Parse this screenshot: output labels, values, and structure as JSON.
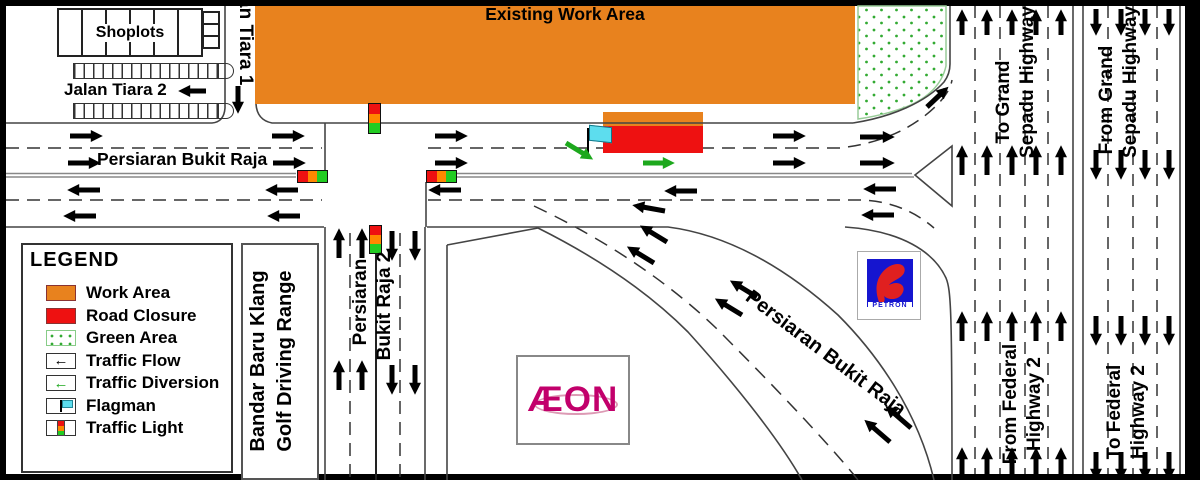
{
  "diagram_title": "Existing Work Area",
  "legend": {
    "title": "LEGEND",
    "items": [
      {
        "label": "Work Area",
        "swatch": "work-area"
      },
      {
        "label": "Road Closure",
        "swatch": "road-closure"
      },
      {
        "label": "Green Area",
        "swatch": "green-area"
      },
      {
        "label": "Traffic Flow",
        "swatch": "traffic-flow"
      },
      {
        "label": "Traffic Diversion",
        "swatch": "traffic-diversion"
      },
      {
        "label": "Flagman",
        "swatch": "flagman"
      },
      {
        "label": "Traffic Light",
        "swatch": "traffic-light"
      }
    ]
  },
  "roads": {
    "persiaran_bukit_raja_main": "Persiaran Bukit Raja",
    "persiaran_bukit_raja_diagonal": "Persiaran Bukit Raja",
    "persiaran_line1": "Persiaran",
    "persiaran_line2": "Bukit Raja 2",
    "jalan_tiara_1": "Jalan Tiara 1",
    "jalan_tiara_2": "Jalan Tiara 2"
  },
  "highway_labels": {
    "to_grand_line1": "To Grand",
    "to_grand_line2": "Sepadu Highway",
    "from_grand_line1": "From Grand",
    "from_grand_line2": "Sepadu Highway",
    "from_federal_line1": "From Federal",
    "from_federal_line2": "Highway 2",
    "to_federal_line1": "To Federal",
    "to_federal_line2": "Highway 2"
  },
  "landmarks": {
    "shoplots": "Shoplots",
    "golf_line1": "Bandar Baru Klang",
    "golf_line2": "Golf Driving Range",
    "aeon": "ÆON",
    "petron": "PETRON"
  },
  "colors": {
    "work_area": "#E8821E",
    "road_closure": "#EE1111",
    "green_dot": "#33AA33",
    "diversion_green": "#1DA81D",
    "flag_cyan": "#5DDDEE",
    "light_red": "#EE1111",
    "light_amber": "#FF8800",
    "light_green": "#22CC22",
    "aeon_magenta": "#C2006B",
    "petron_blue": "#1515CF",
    "petron_red": "#E02020"
  }
}
